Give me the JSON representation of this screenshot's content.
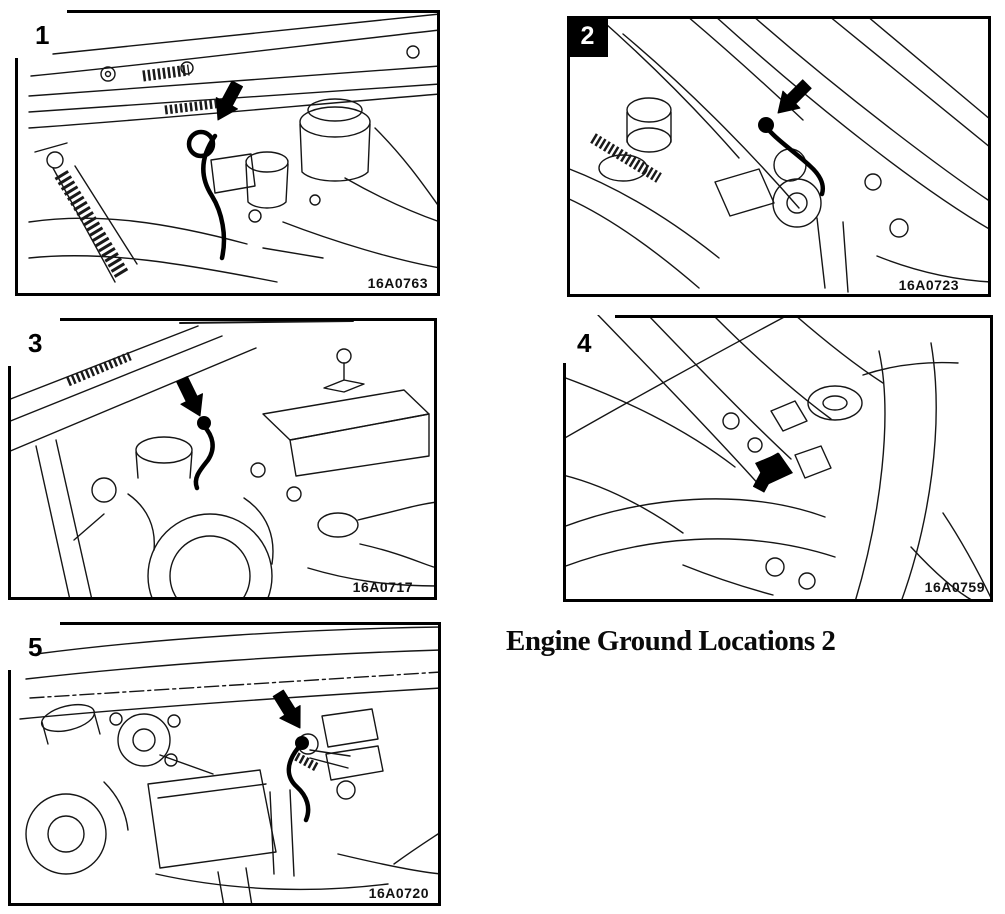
{
  "page": {
    "kind": "service-manual-figure-page",
    "background_color": "#ffffff",
    "ink_color": "#000000"
  },
  "caption": {
    "text": "Engine Ground Locations 2"
  },
  "panels": [
    {
      "number": "1",
      "code": "16A0763",
      "number_style": "plain",
      "arrow_icon": "thick-black-arrow"
    },
    {
      "number": "2",
      "code": "16A0723",
      "number_style": "inverted",
      "arrow_icon": "thick-black-arrow"
    },
    {
      "number": "3",
      "code": "16A0717",
      "number_style": "plain",
      "arrow_icon": "thick-black-arrow"
    },
    {
      "number": "4",
      "code": "16A0759",
      "number_style": "plain",
      "arrow_icon": "thick-black-arrow"
    },
    {
      "number": "5",
      "code": "16A0720",
      "number_style": "plain",
      "arrow_icon": "thick-black-arrow"
    }
  ]
}
